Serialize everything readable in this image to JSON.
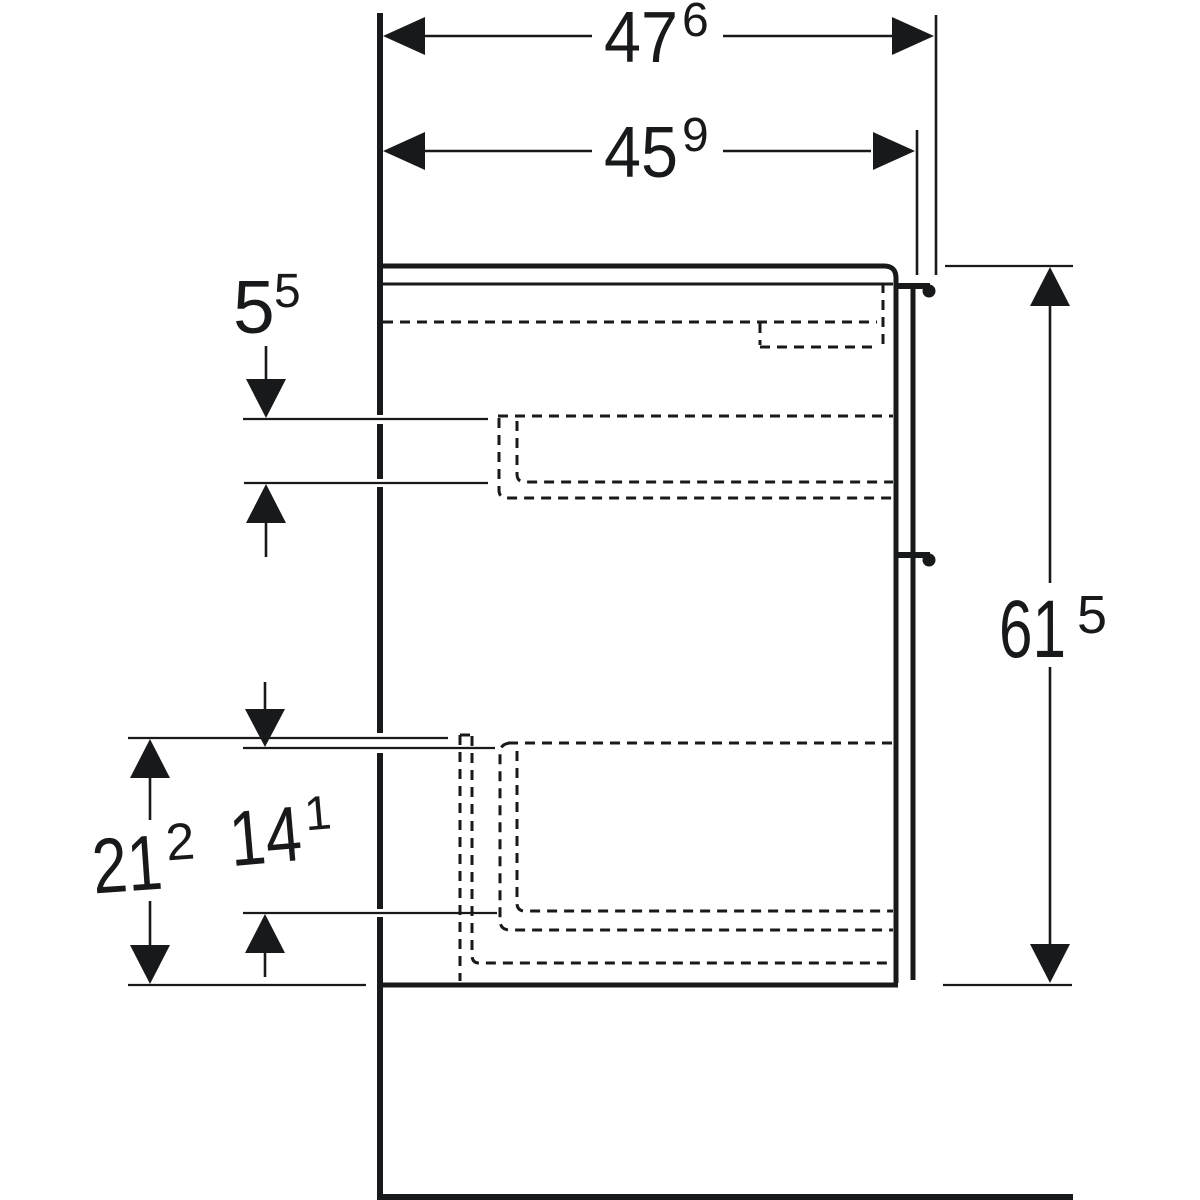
{
  "drawing": {
    "type": "technical-dimension-drawing",
    "subject": "vanity-cabinet-side-section",
    "colors": {
      "ink": "#17191a",
      "background": "#ffffff"
    },
    "dims": {
      "width_total": {
        "value": "47",
        "sup": "6"
      },
      "width_body": {
        "value": "45",
        "sup": "9"
      },
      "front_overlap": {
        "value": "5",
        "sup": "5"
      },
      "height_total": {
        "value": "61",
        "sup": "5"
      },
      "bottom_zone": {
        "value": "21",
        "sup": "2"
      },
      "inner_zone": {
        "value": "14",
        "sup": "1"
      }
    }
  }
}
